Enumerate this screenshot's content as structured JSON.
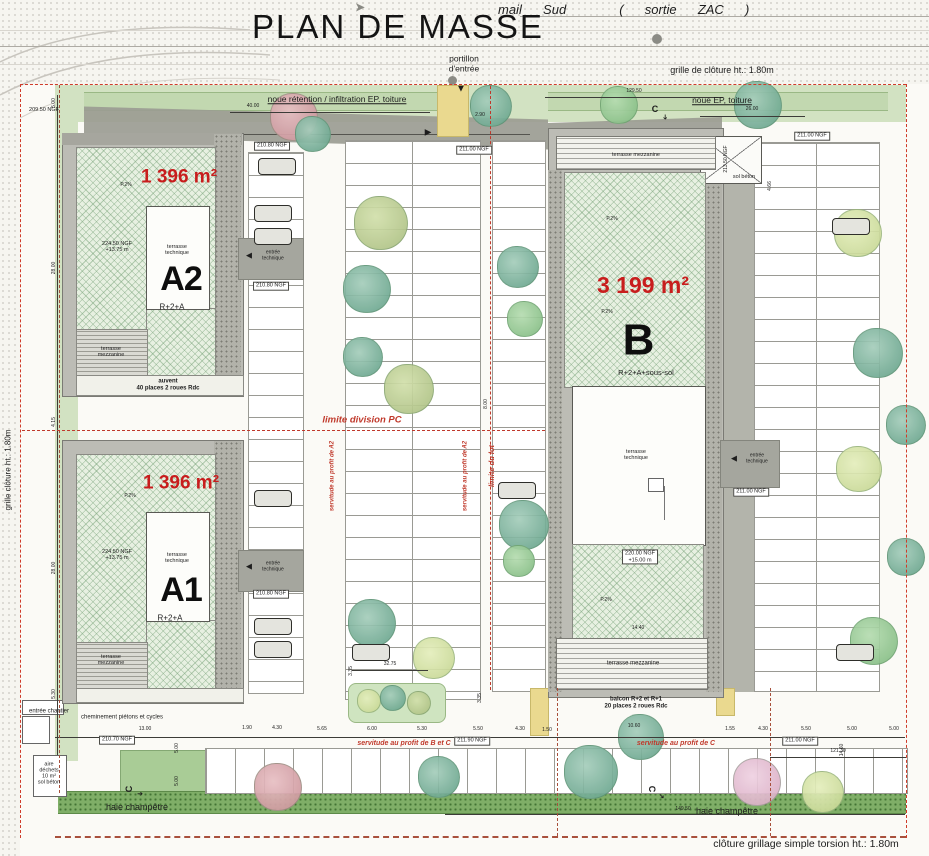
{
  "header": {
    "title": "PLAN DE MASSE",
    "subtitle": "mail  Sud     (  sortie  ZAC  )"
  },
  "colors": {
    "boundary_red": "#cf3b2a",
    "fence_brown": "#a8503c",
    "annotation_red": "#c0392b",
    "area_red": "#c81d1d",
    "roof_green": "#e7f0e1",
    "band_green": "#d2e2c2",
    "hedge_green": "#7fae67",
    "drive_gray": "#9b9c93",
    "yellow_path": "#ead98f"
  },
  "annotations": [
    {
      "n": "portillon-label",
      "t": "portillon\nd'entrée",
      "x": 464,
      "y": 64,
      "s": 8.5
    },
    {
      "n": "portillon-arrow-icon",
      "t": "▼",
      "x": 461,
      "y": 89,
      "s": 10,
      "c": "b"
    },
    {
      "n": "grille-cloture-top-label",
      "t": "grille de clôture ht.: 1.80m",
      "x": 722,
      "y": 70,
      "s": 9
    },
    {
      "n": "noue-retention-label",
      "t": "noue rétention / infiltration EP. toiture",
      "x": 337,
      "y": 100,
      "s": 8.5,
      "c": "ul"
    },
    {
      "n": "noue-ep-label",
      "t": "noue EP, toiture",
      "x": 722,
      "y": 101,
      "s": 8.5,
      "c": "ul"
    },
    {
      "n": "grille-cloture-left-label",
      "t": "grille clôture ht.: 1.80m",
      "x": 9,
      "y": 470,
      "s": 8,
      "r": -90
    },
    {
      "n": "ngf-209-50",
      "t": "209.50 NGF",
      "x": 44,
      "y": 110,
      "s": 5.5
    },
    {
      "n": "road-arrow-icon",
      "t": "➤",
      "x": 360,
      "y": 8,
      "s": 13,
      "c": "gray"
    },
    {
      "n": "drive-arrow-icon",
      "t": "▶",
      "x": 428,
      "y": 133,
      "s": 8,
      "c": "b"
    },
    {
      "n": "area-a2",
      "t": "1 396 m²",
      "x": 179,
      "y": 177,
      "s": 19,
      "c": "red"
    },
    {
      "t": "P.2%",
      "x": 126,
      "y": 186,
      "s": 5
    },
    {
      "t": "224.50 NGF\n+13.75 m",
      "x": 117,
      "y": 247,
      "s": 5.5
    },
    {
      "t": "terrasse\ntechnique",
      "x": 177,
      "y": 250,
      "s": 5.5
    },
    {
      "n": "building-a2-label",
      "t": "A2",
      "x": 181,
      "y": 279,
      "s": 34,
      "c": "bld"
    },
    {
      "t": "R+2+A",
      "x": 172,
      "y": 308,
      "s": 8
    },
    {
      "t": "terrasse\nmezzanine",
      "x": 111,
      "y": 352,
      "s": 5.5
    },
    {
      "n": "auvent-label",
      "t": "auvent\n40 places 2 roues Rdc",
      "x": 168,
      "y": 385,
      "s": 6,
      "c": "b"
    },
    {
      "n": "entree-technique-a2-arrow-icon",
      "t": "◄",
      "x": 249,
      "y": 256,
      "s": 10,
      "c": "b"
    },
    {
      "t": "entrée\ntechnique",
      "x": 273,
      "y": 256,
      "s": 5
    },
    {
      "t": "210.80 NGF",
      "x": 271,
      "y": 286,
      "s": 5.5,
      "c": "ngf"
    },
    {
      "t": "210.80 NGF",
      "x": 272,
      "y": 146,
      "s": 5.5,
      "c": "ngf"
    },
    {
      "t": "211.00 NGF",
      "x": 474,
      "y": 150,
      "s": 5.5,
      "c": "ngf"
    },
    {
      "n": "area-a1",
      "t": "1 396 m²",
      "x": 181,
      "y": 483,
      "s": 19,
      "c": "red"
    },
    {
      "t": "P.2%",
      "x": 130,
      "y": 497,
      "s": 5
    },
    {
      "t": "224.50 NGF\n+13.75 m",
      "x": 117,
      "y": 555,
      "s": 5.5
    },
    {
      "t": "terrasse\ntechnique",
      "x": 177,
      "y": 558,
      "s": 5.5
    },
    {
      "n": "building-a1-label",
      "t": "A1",
      "x": 181,
      "y": 590,
      "s": 34,
      "c": "bld"
    },
    {
      "t": "R+2+A",
      "x": 170,
      "y": 619,
      "s": 8
    },
    {
      "t": "terrasse\nmezzanine",
      "x": 111,
      "y": 660,
      "s": 5.5
    },
    {
      "n": "entree-technique-a1-arrow-icon",
      "t": "◄",
      "x": 249,
      "y": 567,
      "s": 10,
      "c": "b"
    },
    {
      "t": "entrée\ntechnique",
      "x": 273,
      "y": 567,
      "s": 5
    },
    {
      "t": "210.80 NGF",
      "x": 271,
      "y": 594,
      "s": 5.5,
      "c": "ngf"
    },
    {
      "t": "terrasse mezzanine",
      "x": 636,
      "y": 155,
      "s": 5.5
    },
    {
      "t": "P.2%",
      "x": 612,
      "y": 220,
      "s": 5
    },
    {
      "n": "area-b",
      "t": "3 199 m²",
      "x": 643,
      "y": 286,
      "s": 23,
      "c": "red"
    },
    {
      "t": "P.2%",
      "x": 607,
      "y": 313,
      "s": 5
    },
    {
      "n": "building-b-label",
      "t": "B",
      "x": 638,
      "y": 340,
      "s": 44,
      "c": "bld"
    },
    {
      "t": "R+2+A+sous-sol",
      "x": 646,
      "y": 373,
      "s": 7.5
    },
    {
      "t": "terrasse\ntechnique",
      "x": 636,
      "y": 455,
      "s": 5.5
    },
    {
      "t": "220.00 NGF\n+15.00 m",
      "x": 640,
      "y": 557,
      "s": 5.5,
      "c": "ngf"
    },
    {
      "t": "P.2%",
      "x": 606,
      "y": 601,
      "s": 5
    },
    {
      "t": "14.40",
      "x": 638,
      "y": 629,
      "s": 5
    },
    {
      "t": "terrasse mezzanine",
      "x": 633,
      "y": 664,
      "s": 6
    },
    {
      "n": "balcon-label",
      "t": "balcon R+2 et R+1\n20 places 2 roues Rdc",
      "x": 636,
      "y": 703,
      "s": 6,
      "c": "b"
    },
    {
      "n": "entree-technique-b-arrow-icon",
      "t": "◄",
      "x": 734,
      "y": 459,
      "s": 10,
      "c": "b"
    },
    {
      "t": "entrée\ntechnique",
      "x": 757,
      "y": 459,
      "s": 5
    },
    {
      "t": "211.00 NGF",
      "x": 751,
      "y": 492,
      "s": 5.5,
      "c": "ngf"
    },
    {
      "t": "213.50 NGF",
      "x": 727,
      "y": 159,
      "s": 5,
      "r": -90
    },
    {
      "t": "sol béton",
      "x": 744,
      "y": 177,
      "s": 5.5
    },
    {
      "t": "211.00 NGF",
      "x": 812,
      "y": 136,
      "s": 5.5,
      "c": "ngf"
    },
    {
      "t": "4.66",
      "x": 771,
      "y": 186,
      "s": 5,
      "r": -90
    },
    {
      "n": "limite-division-pc",
      "t": "limite division PC",
      "x": 362,
      "y": 421,
      "s": 9.5,
      "c": "redit"
    },
    {
      "n": "servitude-a2-left",
      "t": "servitude au profit de A2",
      "x": 333,
      "y": 476,
      "s": 6,
      "c": "redit",
      "r": -90
    },
    {
      "n": "servitude-a2-right",
      "t": "servitude au profit de A2",
      "x": 466,
      "y": 476,
      "s": 6,
      "c": "redit",
      "r": -90
    },
    {
      "n": "limite-du-lot",
      "t": "limite du lot",
      "x": 492,
      "y": 466,
      "s": 7.5,
      "c": "redit",
      "r": -90
    },
    {
      "n": "servitude-b-c",
      "t": "servitude au profit de B et C",
      "x": 404,
      "y": 744,
      "s": 7,
      "c": "redit"
    },
    {
      "n": "servitude-c",
      "t": "servitude au profit de C",
      "x": 676,
      "y": 744,
      "s": 7,
      "c": "redit"
    },
    {
      "n": "entree-chantier-label",
      "t": "entrée chantier",
      "x": 49,
      "y": 712,
      "s": 6
    },
    {
      "n": "cheminement-label",
      "t": "cheminement piétons et cycles",
      "x": 122,
      "y": 718,
      "s": 6
    },
    {
      "t": "210.70 NGF",
      "x": 117,
      "y": 740,
      "s": 5.5,
      "c": "ngf"
    },
    {
      "n": "aire-dechets-label",
      "t": "aire\ndéchets\n10 m²\nsol béton",
      "x": 49,
      "y": 774,
      "s": 5.5
    },
    {
      "n": "haie-champetre-left",
      "t": "haie champêtre",
      "x": 137,
      "y": 807,
      "s": 9
    },
    {
      "n": "haie-champetre-right",
      "t": "haie champêtre",
      "x": 727,
      "y": 811,
      "s": 9
    },
    {
      "n": "cloture-grillage-label",
      "t": "clôture grillage simple torsion ht.: 1.80m",
      "x": 806,
      "y": 845,
      "s": 10.5
    },
    {
      "t": "211.90 NGF",
      "x": 472,
      "y": 741,
      "s": 5.5,
      "c": "ngf"
    },
    {
      "t": "211.00 NGF",
      "x": 800,
      "y": 741,
      "s": 5.5,
      "c": "ngf"
    },
    {
      "t": "149.50",
      "x": 683,
      "y": 810,
      "s": 5
    },
    {
      "t": "121.30",
      "x": 838,
      "y": 752,
      "s": 5
    },
    {
      "t": "40.00",
      "x": 253,
      "y": 107,
      "s": 5
    },
    {
      "t": "2.90",
      "x": 480,
      "y": 116,
      "s": 5
    },
    {
      "t": "129.50",
      "x": 634,
      "y": 92,
      "s": 5
    },
    {
      "t": "26.00",
      "x": 752,
      "y": 110,
      "s": 5
    },
    {
      "t": "8.00",
      "x": 487,
      "y": 404,
      "s": 5,
      "r": -90
    },
    {
      "t": "5.00",
      "x": 55,
      "y": 103,
      "s": 5,
      "r": -90
    },
    {
      "t": "28.00",
      "x": 55,
      "y": 268,
      "s": 5,
      "r": -90
    },
    {
      "t": "4.15",
      "x": 55,
      "y": 422,
      "s": 5,
      "r": -90
    },
    {
      "t": "28.00",
      "x": 55,
      "y": 568,
      "s": 5,
      "r": -90
    },
    {
      "t": "5.30",
      "x": 55,
      "y": 694,
      "s": 5,
      "r": -90
    },
    {
      "t": "13.00",
      "x": 145,
      "y": 730,
      "s": 5
    },
    {
      "t": "5.00",
      "x": 178,
      "y": 748,
      "s": 5,
      "r": -90
    },
    {
      "t": "1.90",
      "x": 247,
      "y": 729,
      "s": 5
    },
    {
      "t": "4.30",
      "x": 277,
      "y": 729,
      "s": 5
    },
    {
      "t": "5.65",
      "x": 322,
      "y": 730,
      "s": 5
    },
    {
      "t": "6.00",
      "x": 372,
      "y": 730,
      "s": 5
    },
    {
      "t": "5.30",
      "x": 422,
      "y": 730,
      "s": 5
    },
    {
      "t": "5.50",
      "x": 478,
      "y": 730,
      "s": 5
    },
    {
      "t": "4.30",
      "x": 520,
      "y": 730,
      "s": 5
    },
    {
      "t": "1.50",
      "x": 547,
      "y": 731,
      "s": 5
    },
    {
      "t": "10.60",
      "x": 634,
      "y": 727,
      "s": 5
    },
    {
      "t": "1.55",
      "x": 730,
      "y": 730,
      "s": 5
    },
    {
      "t": "4.30",
      "x": 763,
      "y": 730,
      "s": 5
    },
    {
      "t": "5.50",
      "x": 806,
      "y": 730,
      "s": 5
    },
    {
      "t": "5.00",
      "x": 852,
      "y": 730,
      "s": 5
    },
    {
      "t": "5.00",
      "x": 894,
      "y": 730,
      "s": 5
    },
    {
      "t": "32.75",
      "x": 390,
      "y": 665,
      "s": 5
    },
    {
      "t": "3.35",
      "x": 352,
      "y": 671,
      "s": 5,
      "r": -90
    },
    {
      "t": "3.35",
      "x": 481,
      "y": 698,
      "s": 5,
      "r": -90
    },
    {
      "t": "14.60",
      "x": 843,
      "y": 750,
      "s": 5,
      "r": -90
    },
    {
      "t": "5.00",
      "x": 178,
      "y": 781,
      "s": 5,
      "r": -90
    },
    {
      "n": "c-marker-top",
      "t": "C",
      "x": 655,
      "y": 109,
      "s": 9,
      "c": "b"
    },
    {
      "t": "➔",
      "x": 664,
      "y": 117,
      "s": 7,
      "r": 90
    },
    {
      "n": "c-marker-bottom-left",
      "t": "C",
      "x": 129,
      "y": 789,
      "s": 9,
      "c": "b",
      "r": -90
    },
    {
      "t": "➔",
      "x": 140,
      "y": 795,
      "s": 7
    },
    {
      "n": "c-marker-bottom-right",
      "t": "C",
      "x": 652,
      "y": 789,
      "s": 9,
      "c": "b",
      "r": 90
    },
    {
      "t": "➔",
      "x": 661,
      "y": 797,
      "s": 7,
      "r": 45
    }
  ],
  "site": {
    "tree_colors": {
      "teal": [
        "#a5cdbb",
        "#5f9e85"
      ],
      "green": [
        "#b5dcb0",
        "#7db87d"
      ],
      "olive": [
        "#d2e0ab",
        "#a8bc7e"
      ],
      "lime": [
        "#e4eebc",
        "#c3d48e"
      ],
      "rose": [
        "#e7bfc3",
        "#c98f96"
      ],
      "pink": [
        "#efd2e2",
        "#d7a8c0"
      ]
    },
    "trees": [
      [
        293,
        116,
        46,
        "rose"
      ],
      [
        312,
        133,
        34,
        "teal"
      ],
      [
        490,
        105,
        40,
        "teal"
      ],
      [
        618,
        104,
        36,
        "green"
      ],
      [
        757,
        104,
        46,
        "teal"
      ],
      [
        380,
        222,
        52,
        "olive"
      ],
      [
        366,
        288,
        46,
        "teal"
      ],
      [
        408,
        388,
        48,
        "olive"
      ],
      [
        362,
        356,
        38,
        "teal"
      ],
      [
        517,
        266,
        40,
        "teal"
      ],
      [
        524,
        318,
        34,
        "green"
      ],
      [
        523,
        524,
        48,
        "teal"
      ],
      [
        518,
        560,
        30,
        "green"
      ],
      [
        857,
        232,
        46,
        "lime"
      ],
      [
        877,
        352,
        48,
        "teal"
      ],
      [
        905,
        424,
        38,
        "teal"
      ],
      [
        858,
        468,
        44,
        "lime"
      ],
      [
        905,
        556,
        36,
        "teal"
      ],
      [
        873,
        640,
        46,
        "green"
      ],
      [
        371,
        622,
        46,
        "teal"
      ],
      [
        433,
        657,
        40,
        "lime"
      ],
      [
        640,
        736,
        44,
        "teal"
      ],
      [
        277,
        786,
        46,
        "rose"
      ],
      [
        438,
        776,
        40,
        "teal"
      ],
      [
        590,
        771,
        52,
        "teal"
      ],
      [
        756,
        781,
        46,
        "pink"
      ],
      [
        822,
        791,
        40,
        "lime"
      ],
      [
        368,
        700,
        22,
        "lime"
      ],
      [
        392,
        697,
        24,
        "teal"
      ],
      [
        418,
        702,
        22,
        "olive"
      ]
    ],
    "cars": [
      [
        258,
        158
      ],
      [
        254,
        205
      ],
      [
        254,
        228
      ],
      [
        254,
        490
      ],
      [
        254,
        618
      ],
      [
        254,
        641
      ],
      [
        352,
        644
      ],
      [
        498,
        482
      ],
      [
        832,
        218
      ],
      [
        836,
        644
      ]
    ],
    "parking": [
      {
        "x": 248,
        "y": 152,
        "w": 54,
        "h": 540,
        "d": "h"
      },
      {
        "x": 345,
        "y": 140,
        "w": 67,
        "h": 558,
        "d": "h"
      },
      {
        "x": 412,
        "y": 140,
        "w": 67,
        "h": 558,
        "d": "h"
      },
      {
        "x": 492,
        "y": 140,
        "w": 52,
        "h": 550,
        "d": "h"
      },
      {
        "x": 754,
        "y": 142,
        "w": 62,
        "h": 548,
        "d": "h"
      },
      {
        "x": 816,
        "y": 142,
        "w": 62,
        "h": 548,
        "d": "h"
      },
      {
        "x": 205,
        "y": 748,
        "w": 701,
        "h": 44,
        "d": "v"
      }
    ],
    "islands": [
      {
        "x": 348,
        "y": 683,
        "w": 96,
        "h": 38
      }
    ],
    "yellow_paths": [
      {
        "x": 437,
        "y": 85,
        "w": 30,
        "h": 50
      },
      {
        "x": 530,
        "y": 688,
        "w": 17,
        "h": 46
      },
      {
        "x": 716,
        "y": 688,
        "w": 17,
        "h": 26
      }
    ],
    "boxes": [
      {
        "x": 22,
        "y": 700,
        "w": 40,
        "h": 13
      },
      {
        "x": 22,
        "y": 716,
        "w": 26,
        "h": 26
      },
      {
        "x": 33,
        "y": 755,
        "w": 32,
        "h": 40
      }
    ]
  }
}
